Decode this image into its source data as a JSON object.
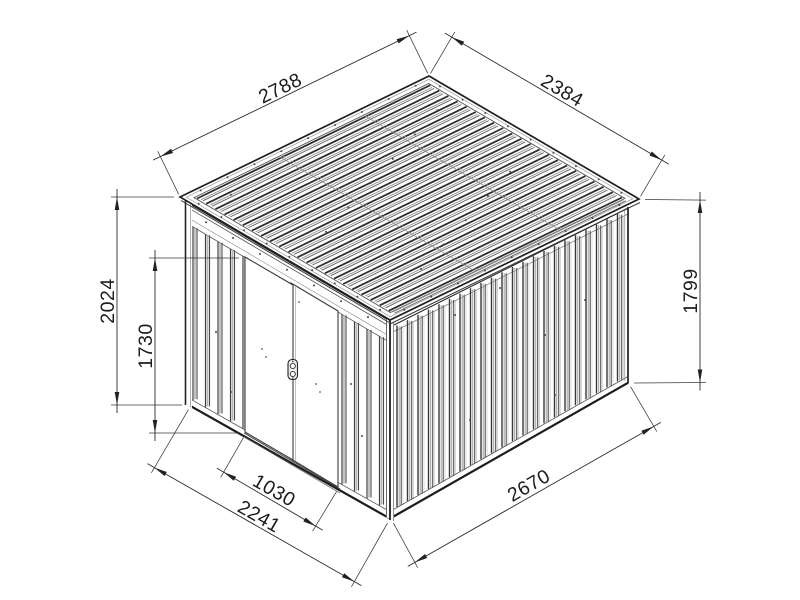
{
  "drawing": {
    "type": "isometric technical line drawing",
    "subject": "pent-roof metal garden shed with double sliding doors",
    "unit": "mm",
    "background_color": "#ffffff",
    "line_color": "#2b2b2b",
    "dimensions": {
      "roof_depth": "2788",
      "roof_width": "2384",
      "front_height": "2024",
      "door_height": "1730",
      "rear_height": "1799",
      "door_width": "1030",
      "front_width": "2241",
      "side_depth": "2670"
    }
  }
}
